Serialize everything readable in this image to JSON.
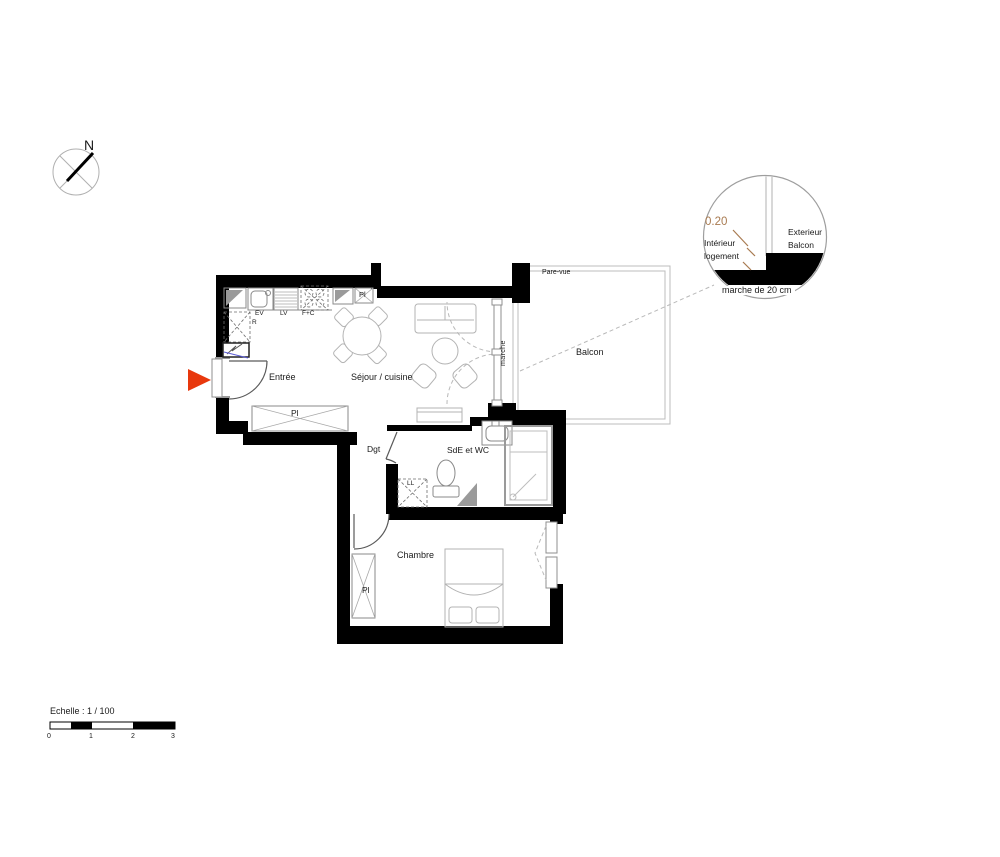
{
  "colors": {
    "wall": "#000000",
    "furniture_line": "#b3b3b3",
    "fixture_line": "#8a8a8a",
    "accent_red": "#e8380d",
    "dimension_orange": "#a87a50",
    "railing_gray": "#bcbcbc",
    "detail_line": "#9e9e9e",
    "panel_blue": "#5c5cd6"
  },
  "compass": {
    "north_label": "N"
  },
  "rooms": {
    "entree": "Entrée",
    "sejour": "Séjour / cuisine",
    "dgt": "Dgt",
    "sde": "SdE et WC",
    "chambre": "Chambre",
    "balcon": "Balcon"
  },
  "fixtures": {
    "closet": "Pl",
    "sink": "EV",
    "dishwasher": "LV",
    "oven": "F+C",
    "fridge": "R",
    "washer": "LL"
  },
  "balcony": {
    "screen": "Pare-vue",
    "step": "marche"
  },
  "detail_callout": {
    "dimension": "0.20",
    "interior_l1": "Intérieur",
    "interior_l2": "logement",
    "exterior_l1": "Exterieur",
    "exterior_l2": "Balcon",
    "caption": "marche de 20 cm"
  },
  "scale_bar": {
    "title": "Echelle : 1 / 100",
    "ticks": [
      "0",
      "1",
      "2",
      "3"
    ]
  }
}
